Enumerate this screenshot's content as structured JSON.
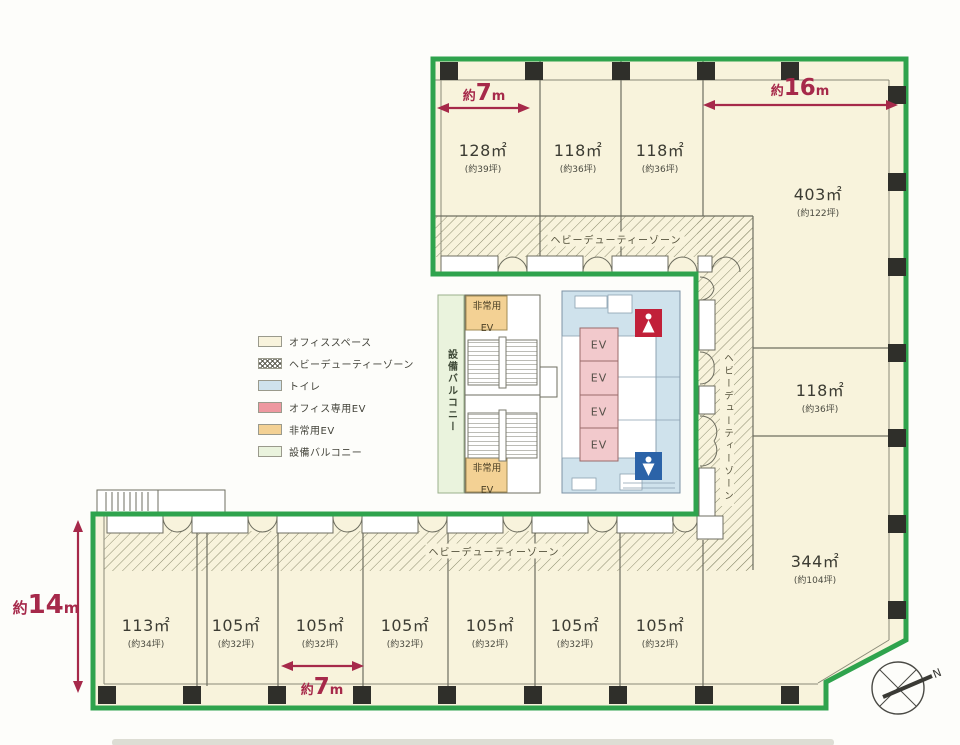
{
  "legend": {
    "items": [
      {
        "label": "オフィススペース"
      },
      {
        "label": "ヘビーデューティーゾーン"
      },
      {
        "label": "トイレ"
      },
      {
        "label": "オフィス専用EV"
      },
      {
        "label": "非常用EV"
      },
      {
        "label": "設備バルコニー"
      }
    ]
  },
  "rooms": {
    "upper": [
      {
        "area": "128㎡",
        "tsubo": "(約39坪)"
      },
      {
        "area": "118㎡",
        "tsubo": "(約36坪)"
      },
      {
        "area": "118㎡",
        "tsubo": "(約36坪)"
      }
    ],
    "right": [
      {
        "area": "403㎡",
        "tsubo": "(約122坪)"
      },
      {
        "area": "118㎡",
        "tsubo": "(約36坪)"
      },
      {
        "area": "344㎡",
        "tsubo": "(約104坪)"
      }
    ],
    "lower": [
      {
        "area": "113㎡",
        "tsubo": "(約34坪)"
      },
      {
        "area": "105㎡",
        "tsubo": "(約32坪)"
      },
      {
        "area": "105㎡",
        "tsubo": "(約32坪)"
      },
      {
        "area": "105㎡",
        "tsubo": "(約32坪)"
      },
      {
        "area": "105㎡",
        "tsubo": "(約32坪)"
      },
      {
        "area": "105㎡",
        "tsubo": "(約32坪)"
      },
      {
        "area": "105㎡",
        "tsubo": "(約32坪)"
      }
    ]
  },
  "dimensions": {
    "top_left": {
      "prefix": "約",
      "value": "7",
      "unit": "m"
    },
    "top_right": {
      "prefix": "約",
      "value": "16",
      "unit": "m"
    },
    "left": {
      "prefix": "約",
      "value": "14",
      "unit": "m"
    },
    "bottom": {
      "prefix": "約",
      "value": "7",
      "unit": "m"
    }
  },
  "zones": {
    "heavy_duty": "ヘビーデューティーゾーン",
    "equipment_balcony": "設備バルコニー",
    "emergency_ev_l1": "非常用",
    "emergency_ev_l2": "EV",
    "ev": "EV"
  },
  "compass": {
    "north": "N"
  },
  "colors": {
    "boundary-green": "#2fa34d",
    "dimension-red": "#a6294a",
    "floor-cream": "#f8f3dc",
    "toilet-blue": "#cfe2ec",
    "office-ev-pink": "#f2c9cc",
    "emergency-ev-orange": "#f3d194",
    "balcony-green": "#eaf3dd",
    "female-red": "#c12039",
    "male-blue": "#2b63a8",
    "column-black": "#2f2f2a"
  }
}
